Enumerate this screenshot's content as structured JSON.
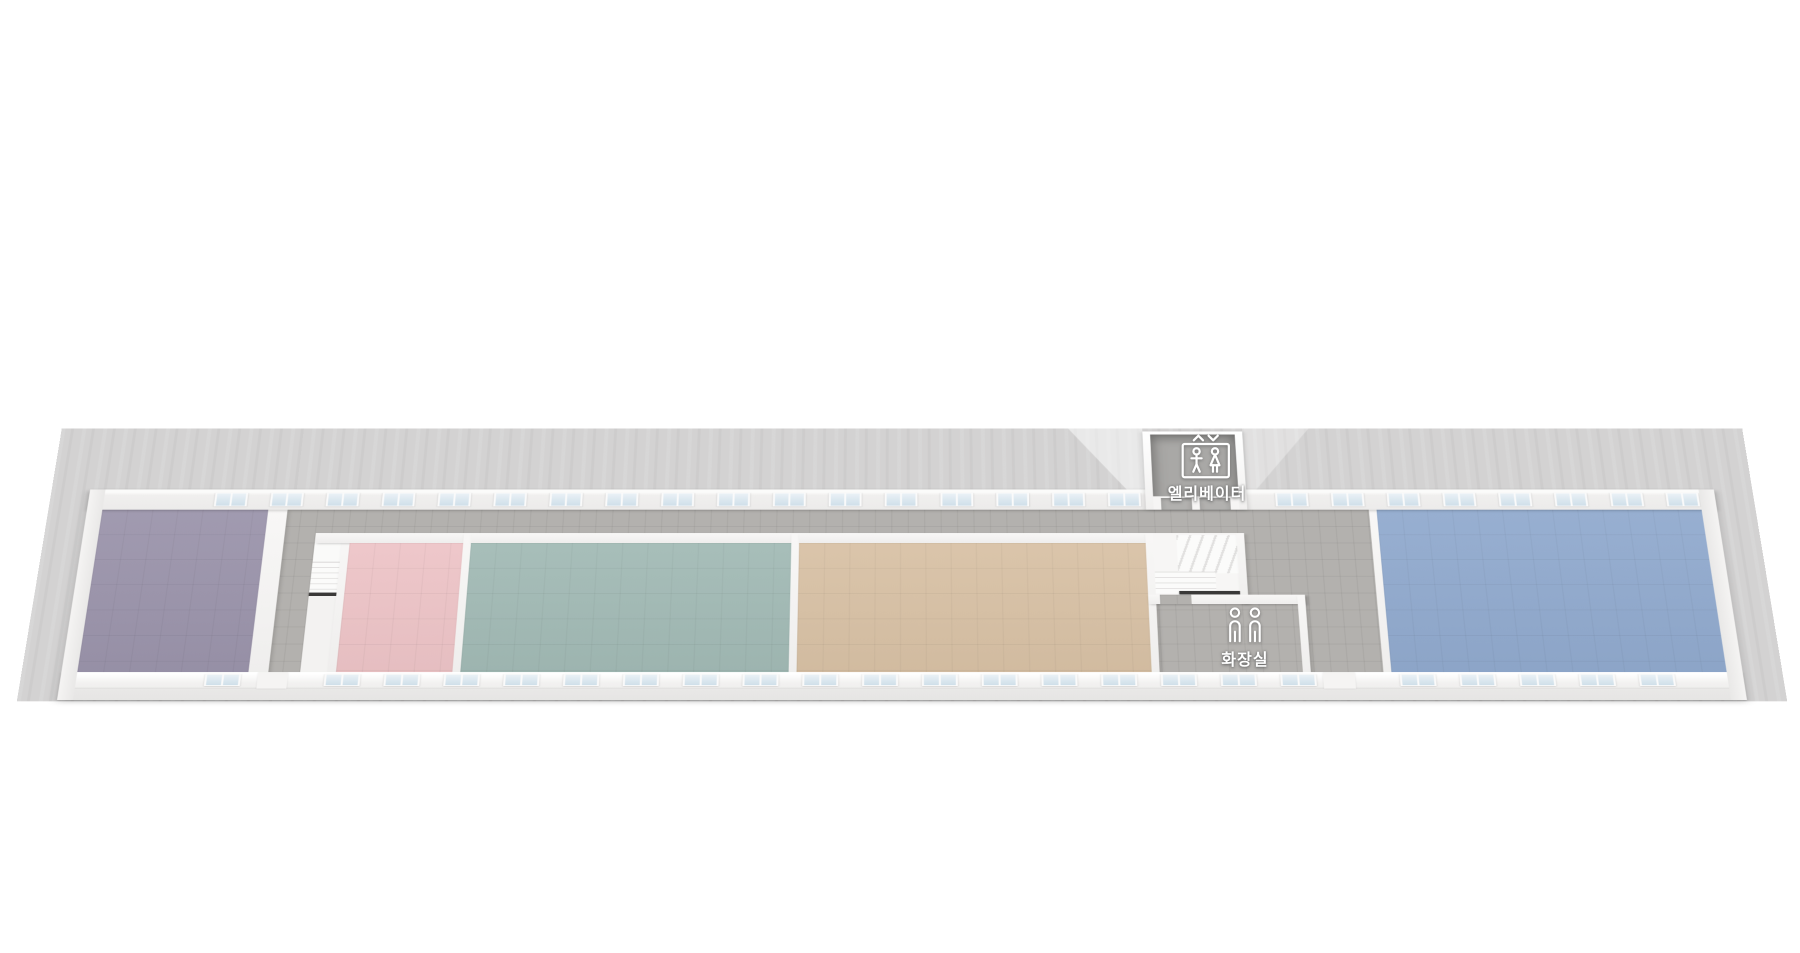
{
  "scene": {
    "description": "Isometric 3D floor plan of a long single-storey building with a central corridor, five color-coded rooms, two staircases, an elevator and a restroom",
    "labels": {
      "elevator": "엘리베이터",
      "restroom": "화장실"
    },
    "colors": {
      "background": "#ffffff",
      "ground": "#d3d2d2",
      "wall": "#f2f1f0",
      "corridor_tile": "#b3b1ae",
      "elevator_shaft_floor": "#a9a8a6",
      "window_glass": "#cfdfe9",
      "stair_gap": "#3a3938"
    },
    "rooms": [
      {
        "id": "purple",
        "color": "#9b94ab"
      },
      {
        "id": "pink",
        "color": "#edc4c7"
      },
      {
        "id": "teal",
        "color": "#a2bab5"
      },
      {
        "id": "tan",
        "color": "#d8c1a5"
      },
      {
        "id": "blue",
        "color": "#91aace"
      }
    ],
    "windows": {
      "top": {
        "count": 27,
        "skip": [
          17,
          18
        ],
        "start": 131,
        "pitch": 58
      },
      "bottom": {
        "count": 25,
        "skip": [
          1,
          19
        ],
        "start": 145,
        "pitch": 60
      }
    },
    "icons": [
      "elevator-icon",
      "restroom-icon"
    ]
  }
}
